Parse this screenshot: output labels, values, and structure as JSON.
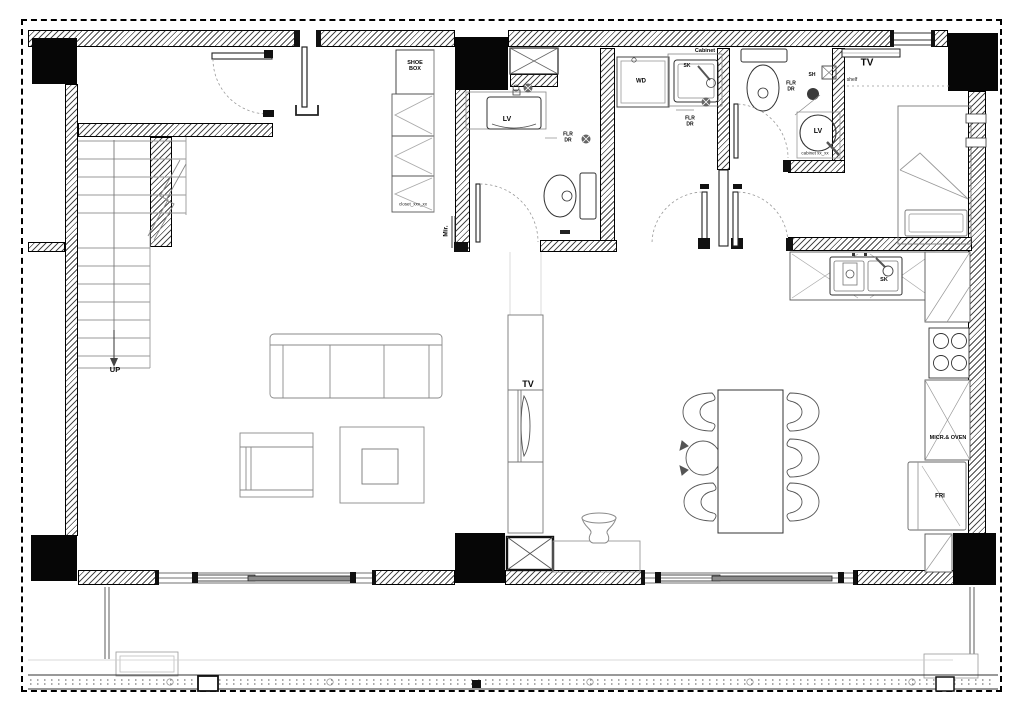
{
  "plan": {
    "title": "residential-unit-floor-plan",
    "labels": {
      "shoe_box": "SHOE BOX",
      "closet": "closet_xxx_xx",
      "mirror": "Mir.",
      "lavatory_bath1": "LV",
      "floor_drain_bath1": "FLR DR",
      "washer_dryer": "WD",
      "sink_laundry": "SK",
      "cabinet_laundry": "Cabinet",
      "floor_drain_laundry": "FLR DR",
      "floor_drain_bath2": "FLR DR",
      "shower_bath2": "SH",
      "lavatory_bath2": "LV",
      "cabinet_bath2": "cabinet xx_xx",
      "tv_bedroom": "TV",
      "shelf_bedroom": "shelf",
      "stairs_up": "UP",
      "tv_living": "TV",
      "sink_kitchen": "SK",
      "microwave_oven": "MICR.& OVEN",
      "fridge": "FRI"
    },
    "colors": {
      "line": "#111111",
      "furniture_line": "#8a8a8a",
      "column_fill": "#060606",
      "background": "#ffffff"
    }
  }
}
